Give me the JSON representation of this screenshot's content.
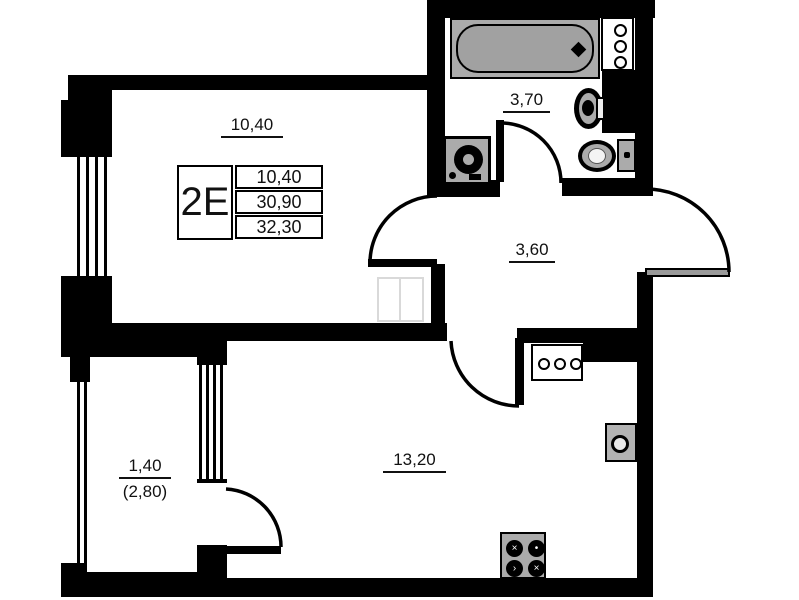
{
  "floorplan": {
    "unit": {
      "type_label": "2E",
      "stats": [
        "10,40",
        "30,90",
        "32,30"
      ]
    },
    "rooms": {
      "living": {
        "area": "10,40"
      },
      "bathroom": {
        "area": "3,70"
      },
      "hallway": {
        "area": "3,60"
      },
      "kitchen": {
        "area": "13,20"
      },
      "balcony": {
        "area": "1,40",
        "area_full": "(2,80)"
      }
    },
    "icons": {
      "stove_burner_marks": [
        "×",
        "•",
        "›",
        "×"
      ]
    },
    "colors": {
      "wall": "#000000",
      "fixture_fill": "#ababab",
      "ghost_furniture": "#d9d9d9",
      "text": "#111111",
      "background": "#ffffff"
    }
  }
}
